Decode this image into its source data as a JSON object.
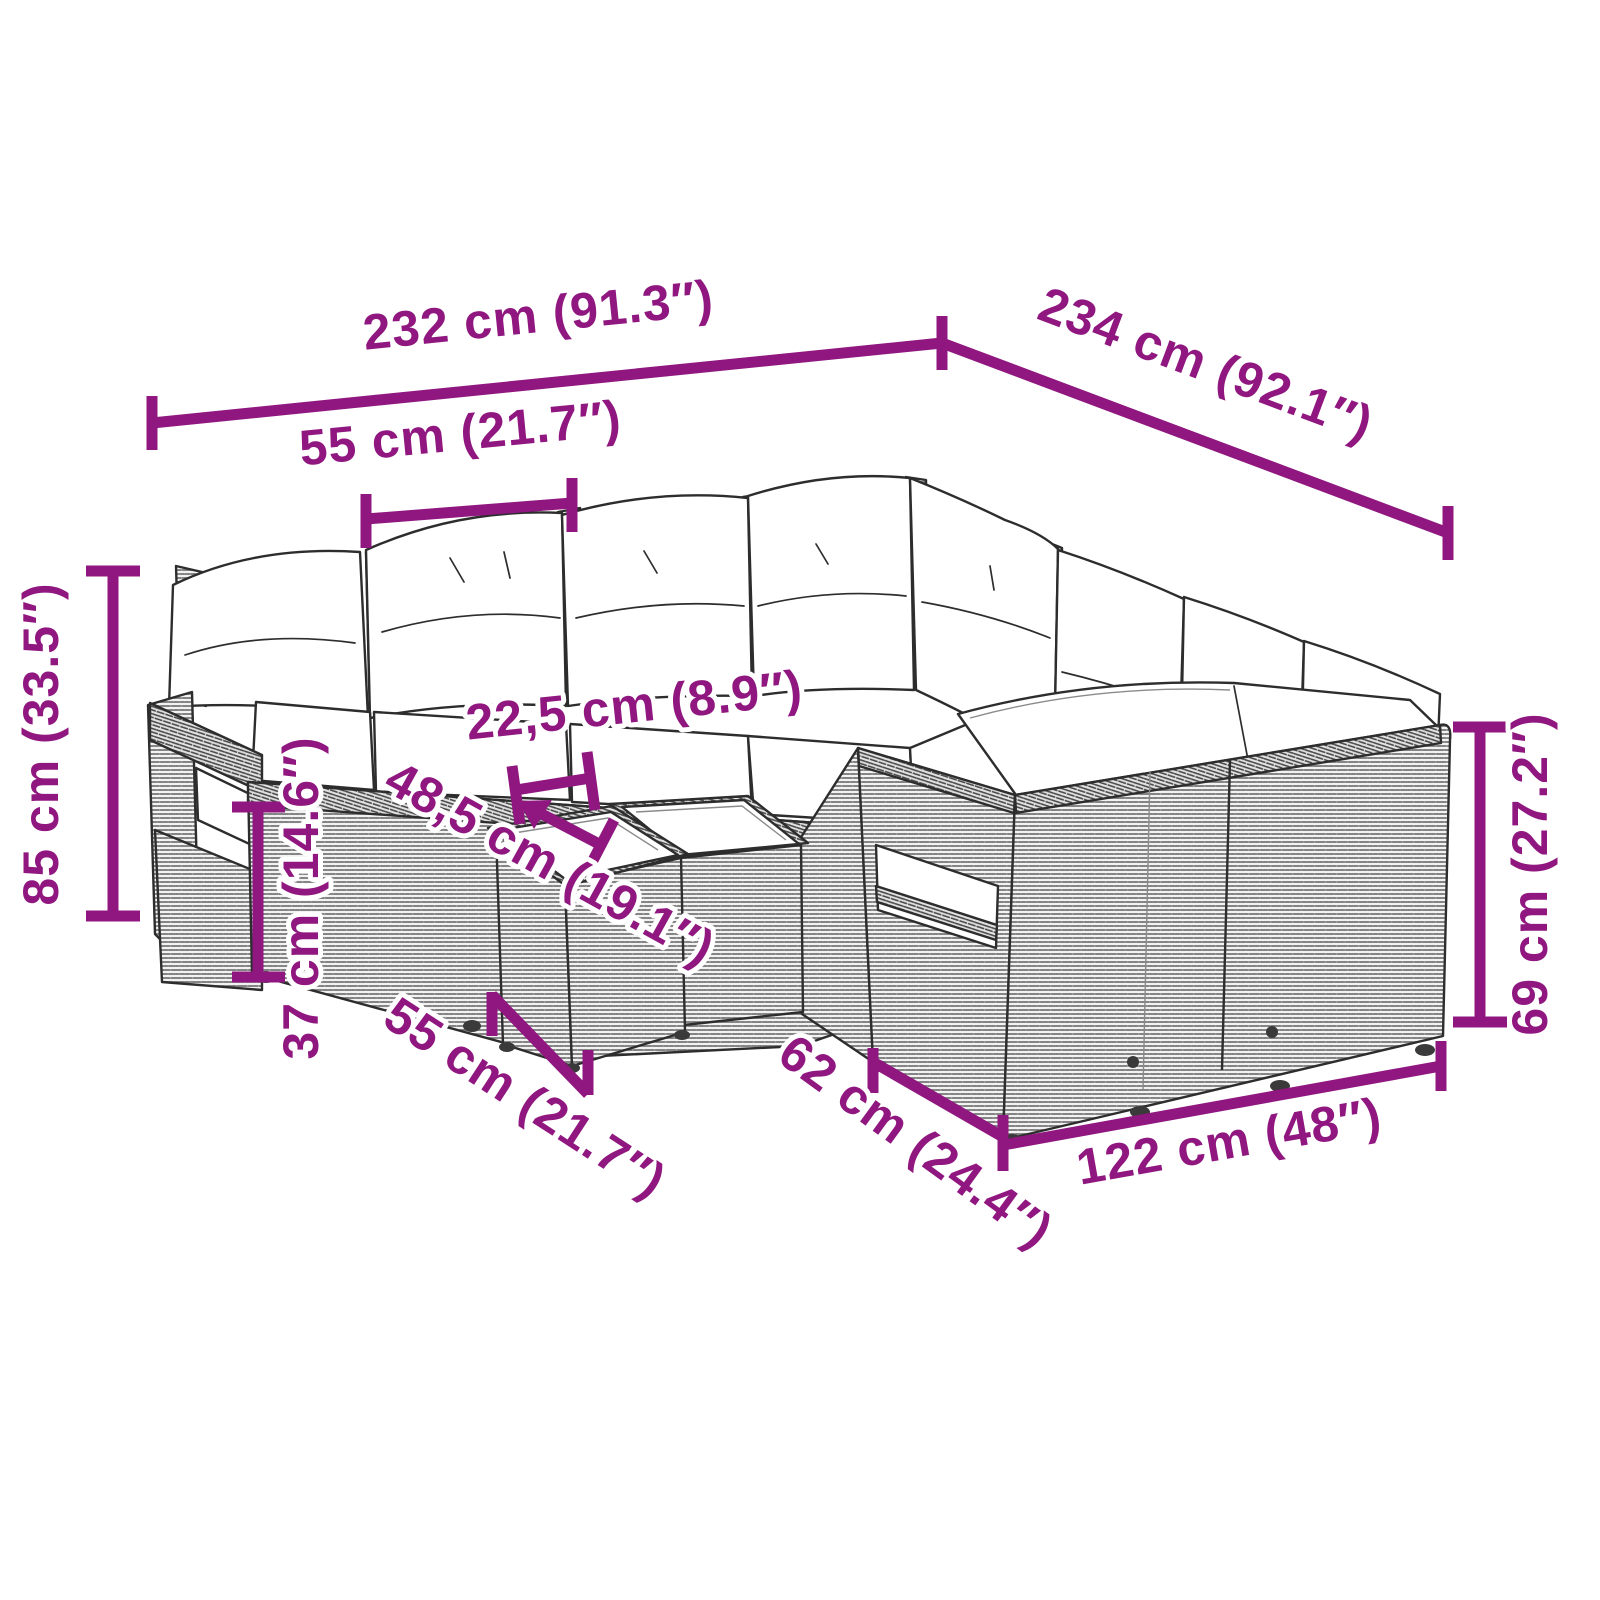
{
  "diagram": {
    "accent_color": "#8F177F",
    "outline_color": "#2D2D2D",
    "cushion_color": "#FFFFFF",
    "rattan_base_color": "#F2F2F2",
    "dimensions": [
      {
        "id": "overall-width",
        "label": "232 cm (91.3″)"
      },
      {
        "id": "overall-depth",
        "label": "234 cm (92.1″)"
      },
      {
        "id": "seat-width",
        "label": "55 cm (21.7″)"
      },
      {
        "id": "overall-height",
        "label": "85 cm (33.5″)"
      },
      {
        "id": "seat-table-gap",
        "label": "22,5 cm (8.9″)"
      },
      {
        "id": "table-depth",
        "label": "48,5 cm (19.1″)"
      },
      {
        "id": "seat-height",
        "label": "37 cm (14.6″)"
      },
      {
        "id": "table-width",
        "label": "55 cm (21.7″)"
      },
      {
        "id": "bench-depth",
        "label": "62 cm (24.4″)"
      },
      {
        "id": "bench-length",
        "label": "122 cm (48″)"
      },
      {
        "id": "backrest-height",
        "label": "69 cm (27.2″)"
      }
    ]
  }
}
